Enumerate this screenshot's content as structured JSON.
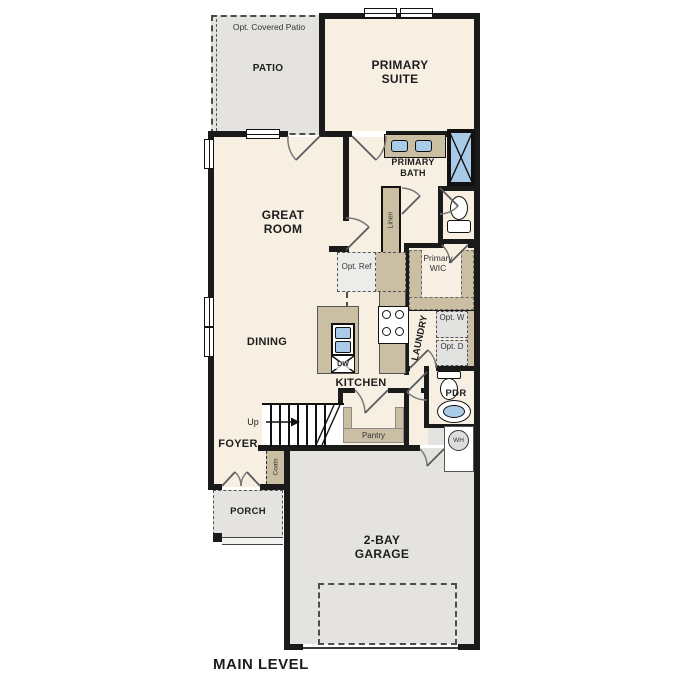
{
  "title": "MAIN LEVEL",
  "colors": {
    "floor": "#f6efe2",
    "hardscape": "#e4e3e0",
    "cabinetry": "#cbbfa3",
    "fixture_blue": "#a9cbe8",
    "wall": "#1a1a1a"
  },
  "labels": {
    "opt_covered_patio": "Opt. Covered Patio",
    "patio": "PATIO",
    "primary_suite": "PRIMARY SUITE",
    "primary_bath": "PRIMARY BATH",
    "linen": "Linen",
    "great_room": "GREAT ROOM",
    "opt_ref": "Opt. Ref",
    "primary_wic": "Primary WIC",
    "dining": "DINING",
    "kitchen": "KITCHEN",
    "laundry": "LAUNDRY",
    "opt_w": "Opt. W",
    "opt_d": "Opt. D",
    "dw": "DW",
    "pdr": "PDR",
    "wh": "WH",
    "up": "Up",
    "pantry": "Pantry",
    "foyer": "FOYER",
    "coats": "Coats",
    "porch": "PORCH",
    "garage": "2-BAY GARAGE",
    "main_level": "MAIN LEVEL"
  }
}
